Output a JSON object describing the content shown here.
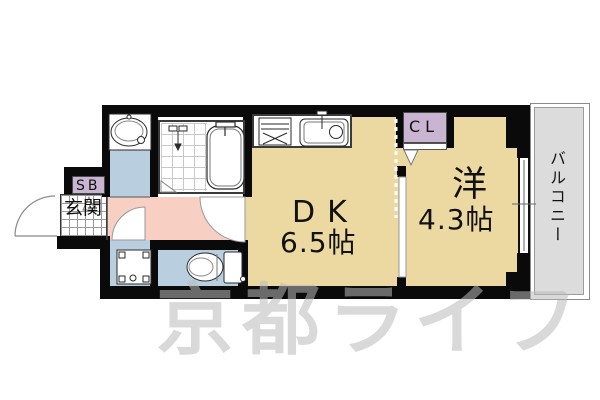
{
  "title": "apartment-floor-plan",
  "rooms": {
    "dk": {
      "label": "DK",
      "size": "6.5帖"
    },
    "western": {
      "label": "洋",
      "size": "4.3帖"
    },
    "closet": {
      "label": "CL"
    },
    "shoe_box": {
      "label": "SB"
    },
    "entrance": {
      "label": "玄関"
    },
    "balcony": {
      "label": "バルコニー"
    }
  },
  "watermark": {
    "text": "京都ライフ"
  },
  "fixtures": [
    "kitchen-stove",
    "kitchen-sink",
    "bathtub",
    "shower",
    "washbasin",
    "washing-machine",
    "toilet",
    "window",
    "front-door",
    "closet-folding-door",
    "sliding-partition"
  ],
  "colors": {
    "wall": "#0a0a0a",
    "room_floor": "#ecd9a2",
    "hallway_floor": "#f7d0c3",
    "wet_area_floor": "#b9cfe0",
    "closet_fill": "#c9b4d2",
    "balcony_floor": "#dcdcdc",
    "watermark_gray": "#bababa"
  }
}
